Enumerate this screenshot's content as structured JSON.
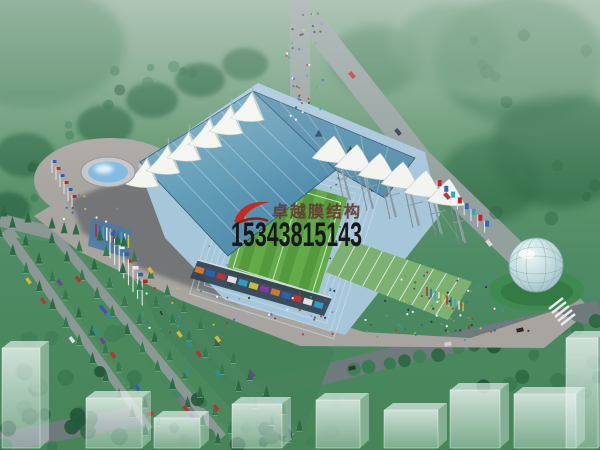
{
  "watermark": {
    "logo": "red-swoosh-bird-icon",
    "logo_color": "#c62b20",
    "company_name": "卓越膜结构",
    "company_color": "#6a3a35",
    "phone_number": "15343815143",
    "phone_color": "#17171c"
  },
  "scene": {
    "subject": "aerial rendering of a membrane-roof stadium with plaza, fountain, glass sphere, roads, parking and landscaping",
    "palette": {
      "haze_green": "#8cab97",
      "grass": "#4e8e66",
      "trees": "#2f6b47",
      "road": "#93a09e",
      "plaza": "#a8a5a0",
      "stadium_roof": "#5f9ab5",
      "seating": "#a6c6da",
      "pitch": "#5ba344",
      "membrane": "#f2f4f0",
      "terraces": "#7cb171",
      "fountain_water": "#7fb9e0",
      "sphere_glass": "#bcd8da",
      "ghost_building": "#e9f4f2"
    }
  }
}
